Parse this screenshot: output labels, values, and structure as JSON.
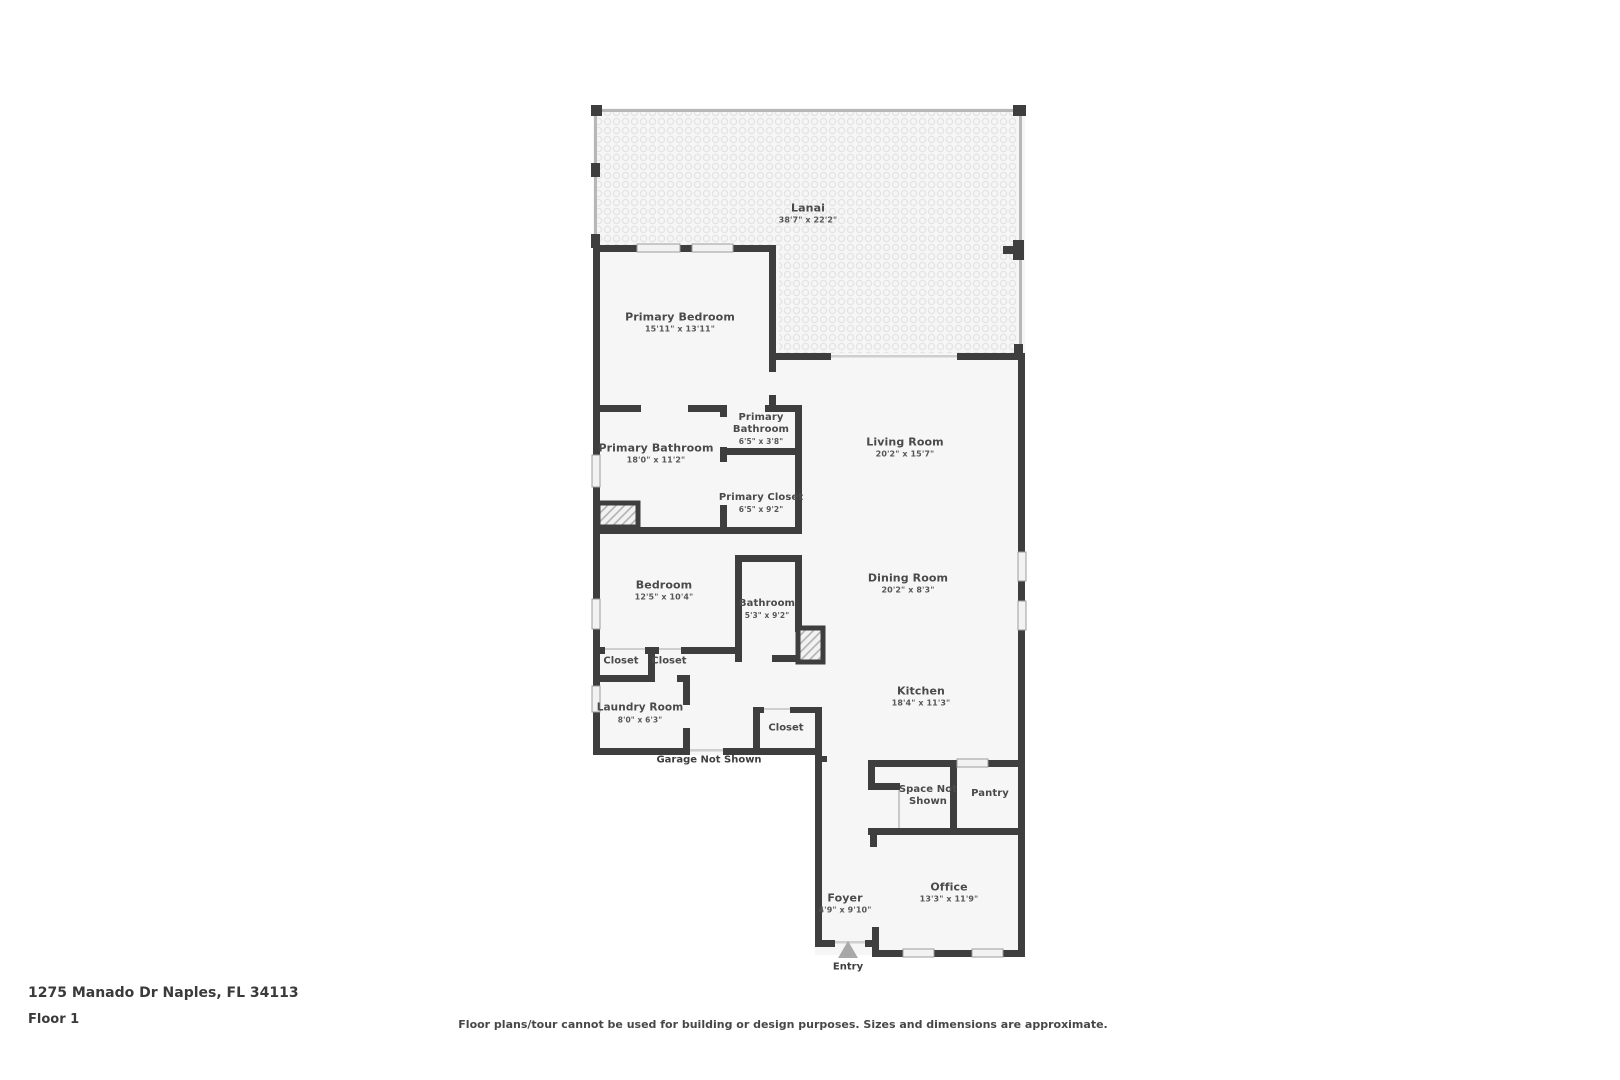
{
  "page": {
    "address": "1275 Manado Dr Naples, FL 34113",
    "floor": "Floor 1",
    "disclaimer": "Floor plans/tour cannot be used for building or design purposes. Sizes and dimensions are approximate."
  },
  "rooms": {
    "lanai": {
      "name": "Lanai",
      "dims": "38'7\" x 22'2\""
    },
    "primary_bedroom": {
      "name": "Primary Bedroom",
      "dims": "15'11\" x 13'11\""
    },
    "primary_bathroom_small": {
      "name": "Primary Bathroom",
      "dims": "6'5\" x 3'8\""
    },
    "primary_bathroom": {
      "name": "Primary Bathroom",
      "dims": "18'0\" x 11'2\""
    },
    "primary_closet": {
      "name": "Primary Closet",
      "dims": "6'5\" x 9'2\""
    },
    "living_room": {
      "name": "Living Room",
      "dims": "20'2\" x 15'7\""
    },
    "dining_room": {
      "name": "Dining Room",
      "dims": "20'2\" x 8'3\""
    },
    "bedroom": {
      "name": "Bedroom",
      "dims": "12'5\" x 10'4\""
    },
    "bathroom": {
      "name": "Bathroom",
      "dims": "5'3\" x 9'2\""
    },
    "laundry_room": {
      "name": "Laundry Room",
      "dims": "8'0\" x 6'3\""
    },
    "kitchen": {
      "name": "Kitchen",
      "dims": "18'4\" x 11'3\""
    },
    "office": {
      "name": "Office",
      "dims": "13'3\" x 11'9\""
    },
    "foyer": {
      "name": "Foyer",
      "dims": "4'9\" x 9'10\""
    },
    "pantry": {
      "name": "Pantry"
    },
    "space_not_shown": {
      "name": "Space Not Shown"
    }
  },
  "closets": [
    "Closet",
    "Closet",
    "Closet"
  ],
  "annotations": {
    "garage_note": "Garage Not Shown",
    "entry": "Entry"
  }
}
